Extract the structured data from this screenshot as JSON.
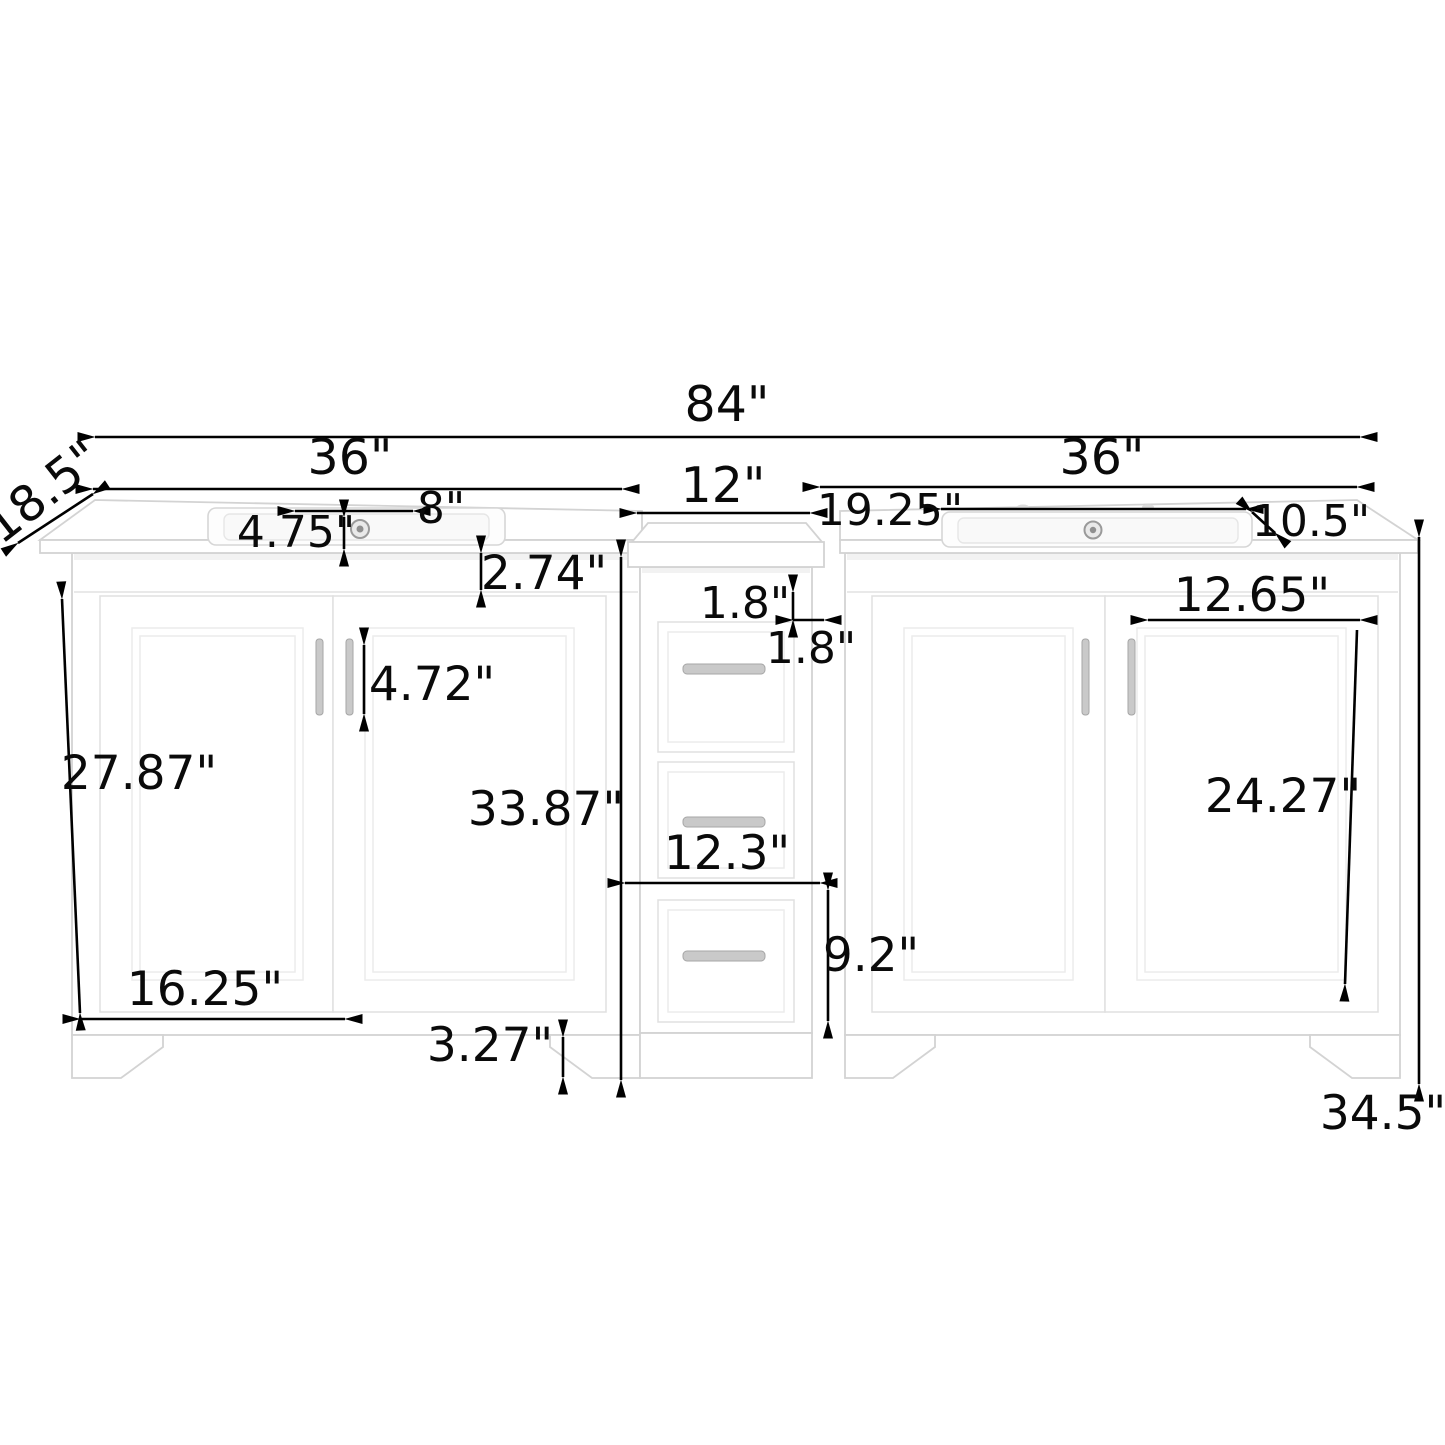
{
  "diagram": {
    "subject": "double sink bathroom vanity with center drawer tower - dimension drawing",
    "unit": "inches",
    "colors": {
      "background": "#ffffff",
      "dimension_line": "#000000",
      "cabinet_outline": "#d3d3d3",
      "hardware": "#c9c9c9"
    },
    "labels": {
      "overall_width": "84\"",
      "left_vanity_width": "36\"",
      "right_vanity_width": "36\"",
      "center_cabinet_width": "12\"",
      "counter_depth": "18.5\"",
      "faucet_spread": "8\"",
      "faucet_setback": "4.75\"",
      "counter_apron_height": "2.74\"",
      "handle_length": "4.72\"",
      "left_door_height": "27.87\"",
      "cabinet_body_height": "33.87\"",
      "top_rail_height": "1.8\"",
      "side_stile_width": "1.8\"",
      "right_sink_left_offset": "19.25\"",
      "right_counter_right_offset": "10.5\"",
      "right_door_panel_width": "12.65\"",
      "right_door_height": "24.27\"",
      "center_drawer_width": "12.3\"",
      "bottom_drawer_height": "9.2\"",
      "left_door_width": "16.25\"",
      "toe_kick_height": "3.27\"",
      "overall_height": "34.5\""
    }
  }
}
